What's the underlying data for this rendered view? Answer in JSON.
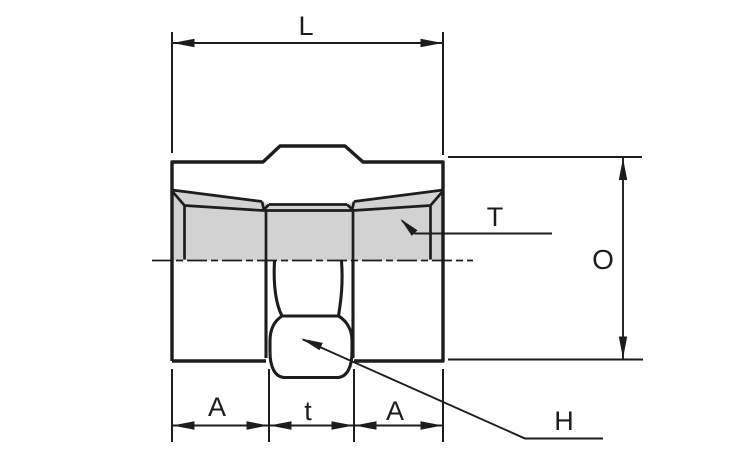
{
  "diagram": {
    "labels": {
      "length": "L",
      "thread": "T",
      "outer_diameter": "O",
      "end_left": "A",
      "center_width": "t",
      "end_right": "A",
      "hex": "H"
    },
    "colors": {
      "line": "#1d1d1b",
      "section_fill": "#d2d2d2",
      "background": "#ffffff"
    }
  }
}
